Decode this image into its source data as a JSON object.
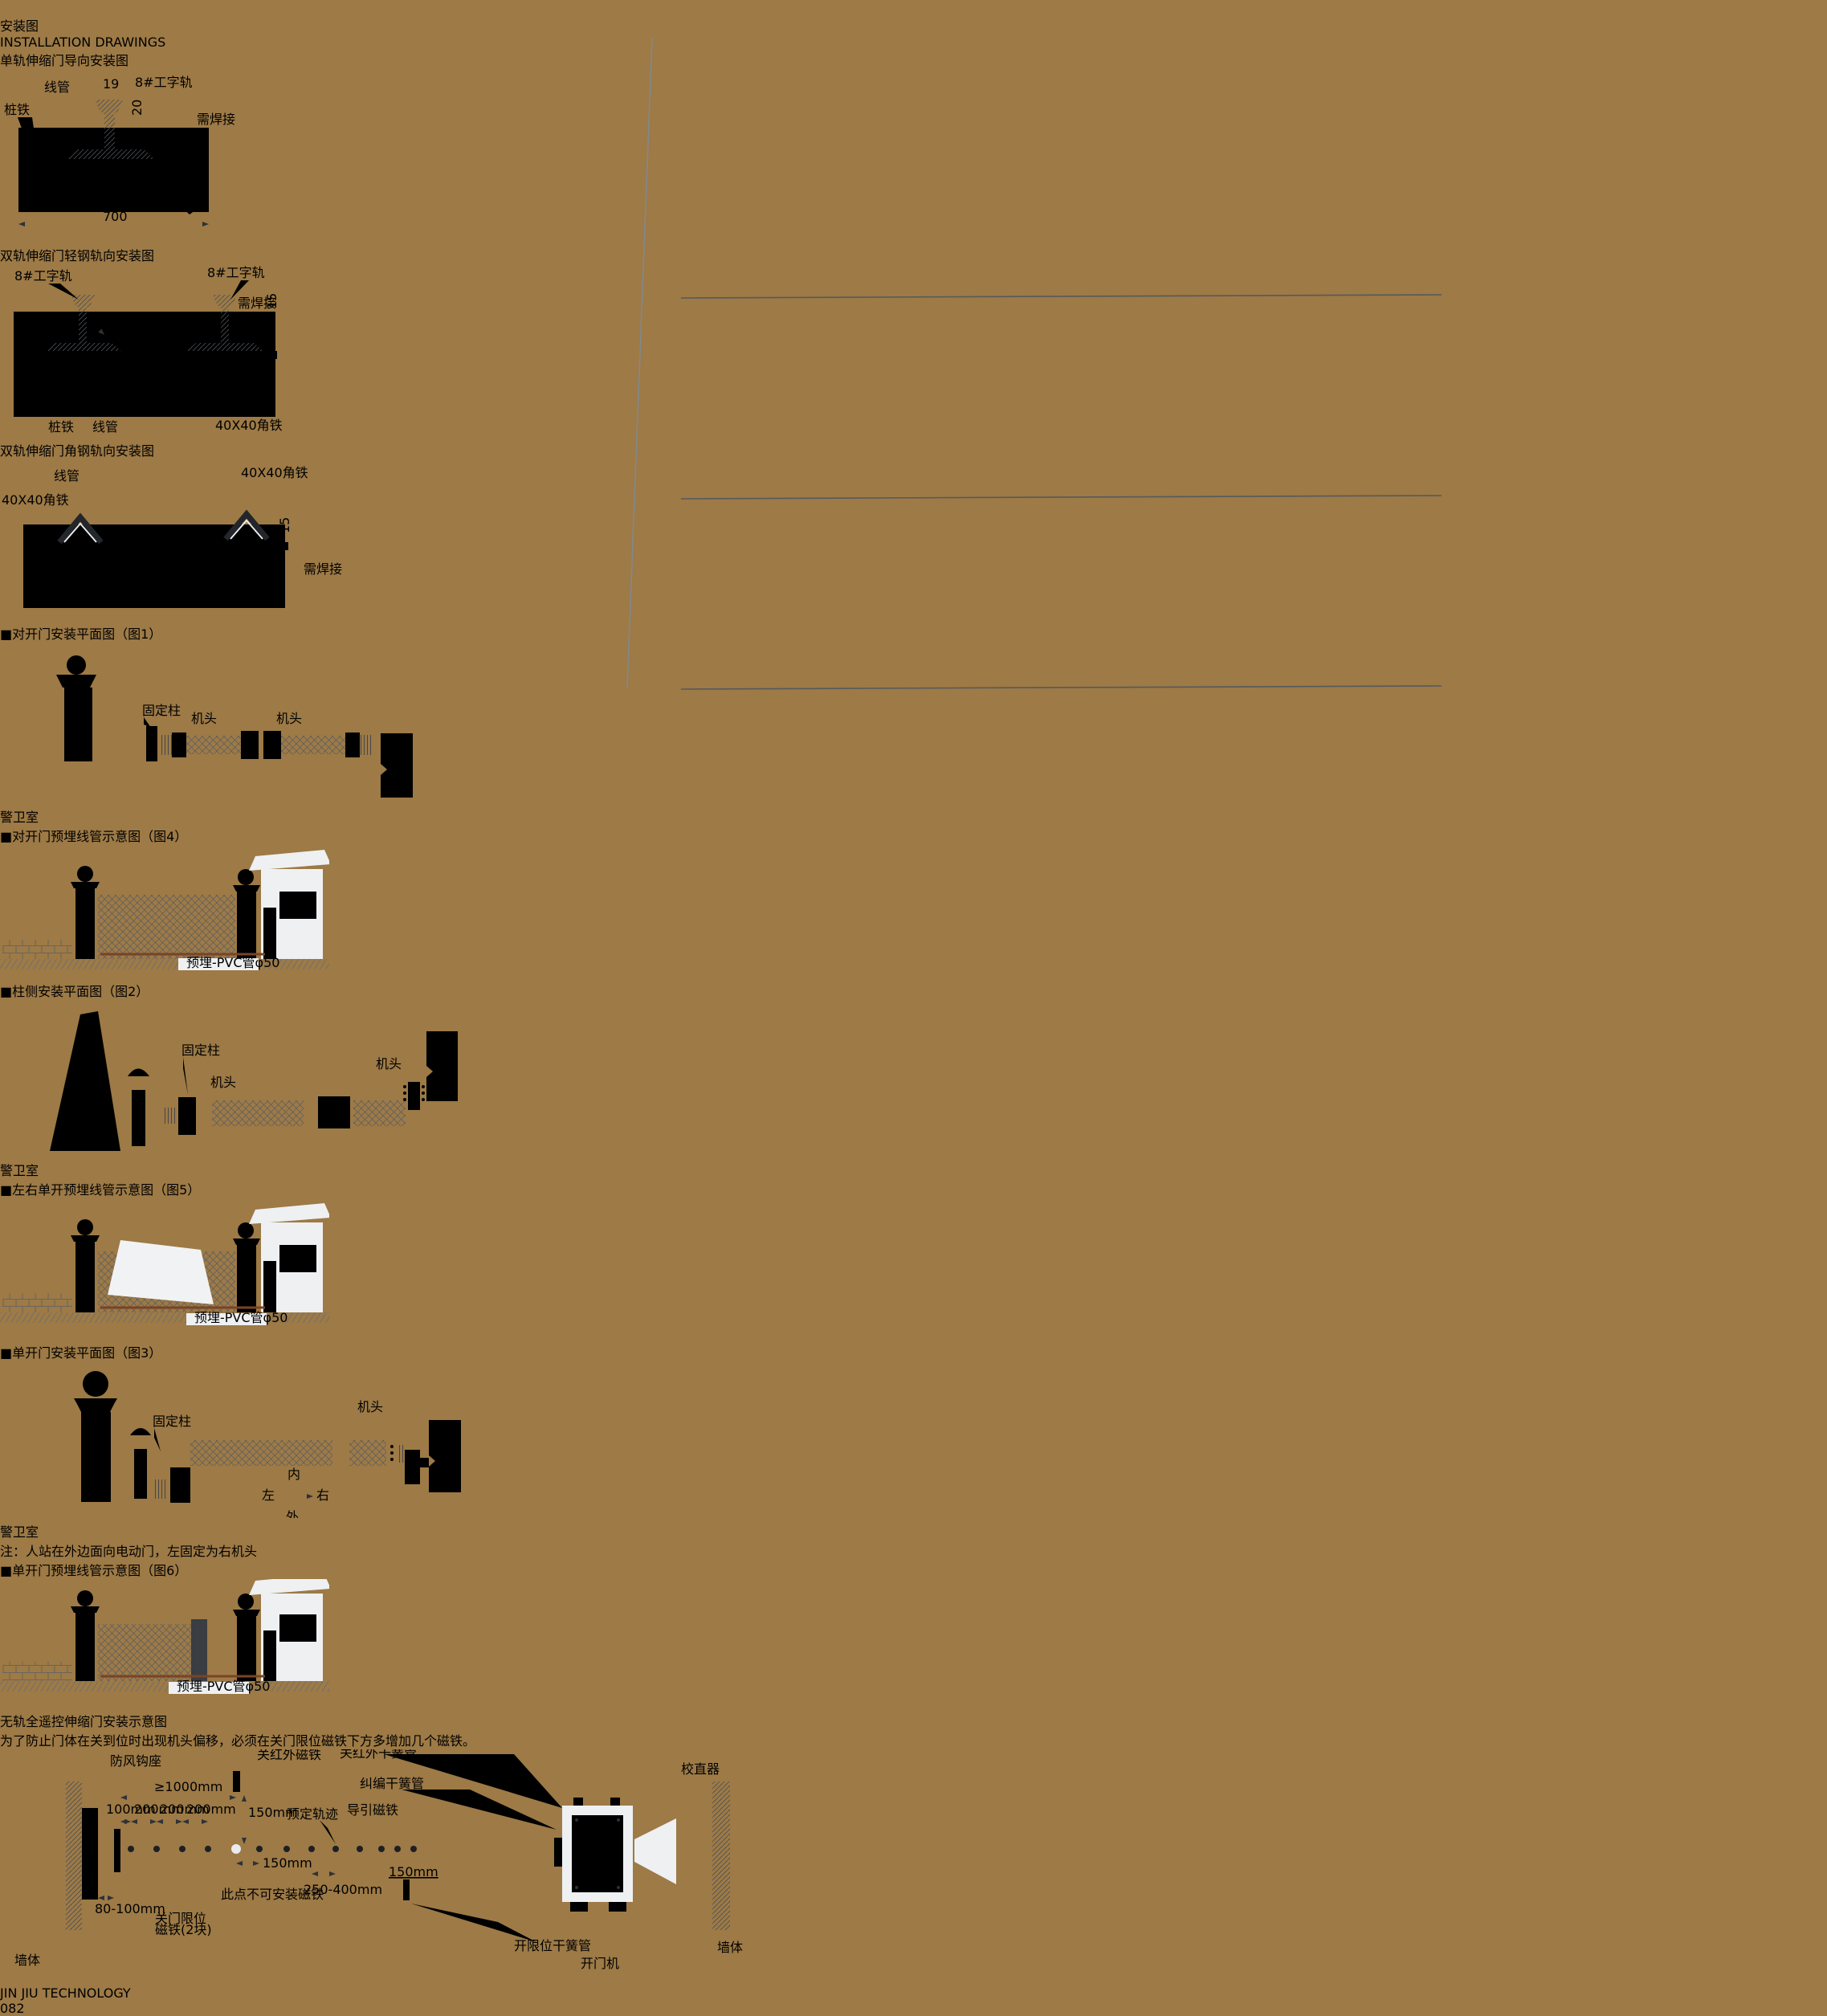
{
  "ui": {
    "bullet": "■"
  },
  "colors": {
    "accent_gold": "#c49a3e",
    "pipe_brown": "#7a4326"
  },
  "header": {
    "title_cn": "安装图",
    "title_en": "INSTALLATION DRAWINGS"
  },
  "footer": {
    "brand": "JIN JIU TECHNOLOGY",
    "page_no": "082"
  },
  "left": {
    "sec1": {
      "title": "单轨伸缩门导向安装图",
      "labels": {
        "xianguan": "线管",
        "rail": "8#工字轨",
        "zhuangtie": "桩铁",
        "d19": "19",
        "d20": "20",
        "d700": "700",
        "weld": "需焊接"
      }
    },
    "sec2": {
      "title": "双轨伸缩门轻钢轨向安装图",
      "labels": {
        "rail_l": "8#工字轨",
        "rail_r": "8#工字轨",
        "d15": "15",
        "weld": "需焊接",
        "zhuangtie": "桩铁",
        "xianguan": "线管",
        "angle": "40X40角铁"
      }
    },
    "sec3": {
      "title": "双轨伸缩门角钢轨向安装图",
      "labels": {
        "xianguan": "线管",
        "angle_l": "40X40角铁",
        "angle_r": "40X40角铁",
        "d15": "15",
        "weld": "需焊接"
      }
    }
  },
  "right": {
    "fig1": {
      "title": "对开门安装平面图（图1）",
      "labels": {
        "guding": "固定柱",
        "jitou_l": "机头",
        "jitou_r": "机头",
        "guard": "警卫室"
      }
    },
    "fig4": {
      "title": "对开门预埋线管示意图（图4）",
      "labels": {
        "pvc": "预埋-PVC管φ50"
      }
    },
    "fig2": {
      "title": "柱侧安装平面图（图2）",
      "labels": {
        "guding": "固定柱",
        "jitou_l": "机头",
        "jitou_r": "机头",
        "guard": "警卫室"
      }
    },
    "fig5": {
      "title": "左右单开预埋线管示意图（图5）",
      "labels": {
        "pvc": "预埋-PVC管φ50"
      }
    },
    "fig3": {
      "title": "单开门安装平面图（图3）",
      "labels": {
        "guding": "固定柱",
        "jitou": "机头",
        "guard": "警卫室",
        "nei": "内",
        "wai": "外",
        "zuo": "左",
        "you": "右"
      },
      "note": "注：人站在外边面向电动门，左固定为右机头"
    },
    "fig6": {
      "title": "单开门预埋线管示意图（图6）",
      "labels": {
        "pvc": "预埋-PVC管φ50"
      }
    }
  },
  "bottom": {
    "title": "无轨全遥控伸缩门安装示意图",
    "note": "为了防止门体在关到位时出现机头偏移，必须在关门限位磁铁下方多增加几个磁铁。",
    "labels": {
      "fangfeng": "防风钩座",
      "qiangti_l": "墙体",
      "qiangti_r": "墙体",
      "guan_citie": "关红外磁铁",
      "guan_ghg": "关红外干簧管",
      "jiupian": "纠编干簧管",
      "xiaozhiqi": "校直器",
      "d1000": "≥1000mm",
      "d100": "100mm",
      "d200a": "200mm",
      "d200b": "200mm",
      "d200c": "200mm",
      "d150a": "150mm",
      "d150b": "150mm",
      "d150c": "150mm",
      "yuding": "预定轨迹",
      "daoyin": "导引磁铁",
      "cidian": "此点不可安装磁铁",
      "d250": "250-400mm",
      "d80": "80-100mm",
      "guanmen1": "关门限位",
      "guanmen2": "磁铁(2块)",
      "kaixianwei": "开限位干簧管",
      "kaimenji": "开门机"
    }
  }
}
